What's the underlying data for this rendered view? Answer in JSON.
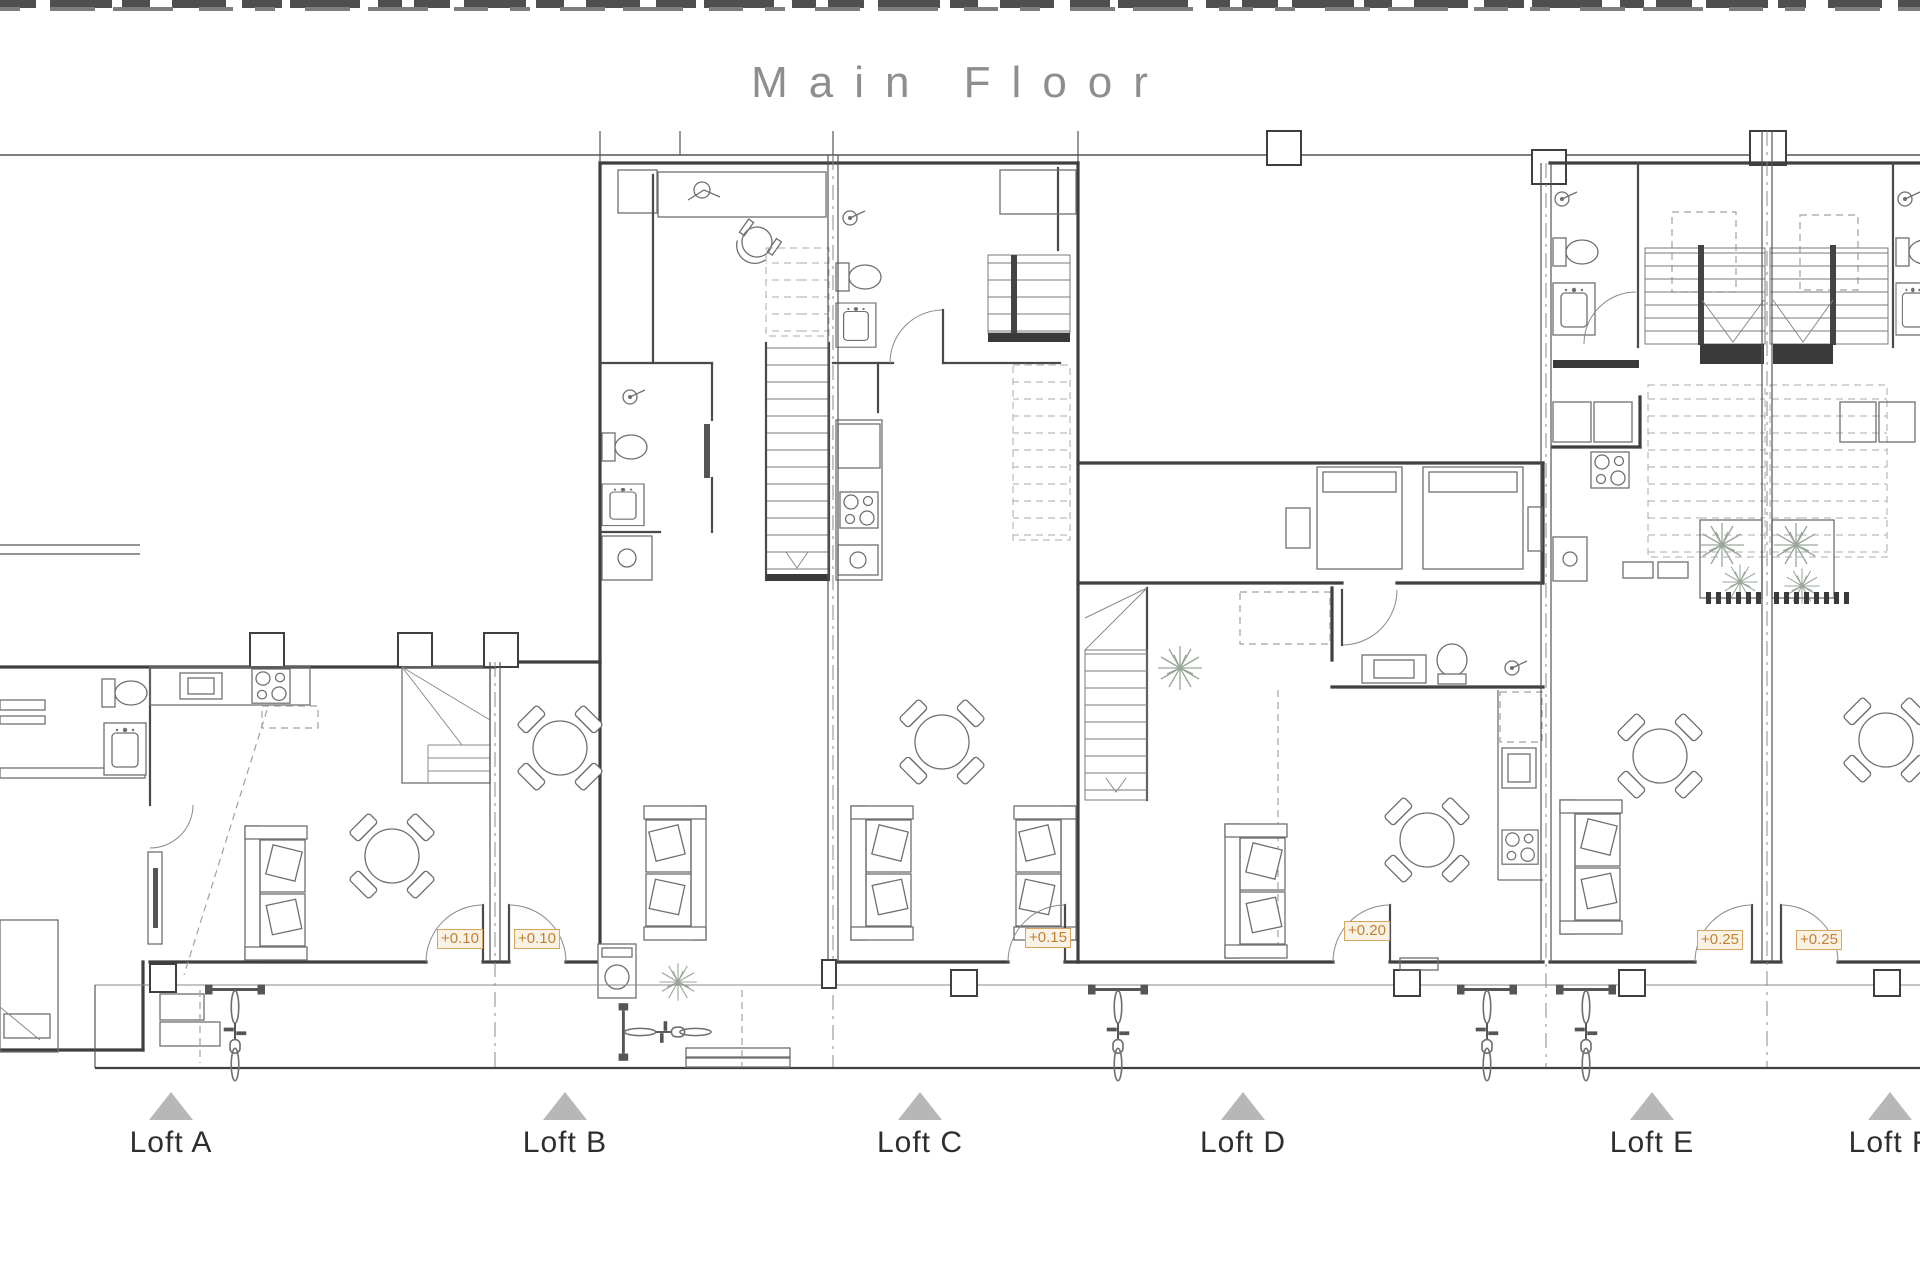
{
  "page": {
    "title": "Main Floor"
  },
  "plan": {
    "units": [
      {
        "id": "loft-a",
        "label": "Loft A"
      },
      {
        "id": "loft-b",
        "label": "Loft B"
      },
      {
        "id": "loft-c",
        "label": "Loft C"
      },
      {
        "id": "loft-d",
        "label": "Loft D"
      },
      {
        "id": "loft-e",
        "label": "Loft E"
      },
      {
        "id": "loft-f",
        "label": "Loft F"
      }
    ],
    "elevation_markers": [
      {
        "unit": "Loft A",
        "value": "+0.10"
      },
      {
        "unit": "Loft B",
        "value": "+0.10"
      },
      {
        "unit": "Loft C",
        "value": "+0.15"
      },
      {
        "unit": "Loft D",
        "value": "+0.20"
      },
      {
        "unit": "Loft E",
        "value": "+0.25"
      },
      {
        "unit": "Loft F",
        "value": "+0.25"
      }
    ],
    "colors": {
      "title_text": "#8e8e8e",
      "label_text": "#2e2e2e",
      "marker_text": "#c08136",
      "marker_border": "#d7a45f",
      "marker_bg": "#faf2e4",
      "triangle": "#b7b7b7",
      "wall": "#3f3f3f",
      "furniture": "#6f6f6f",
      "plant": "#9aa69a"
    }
  }
}
